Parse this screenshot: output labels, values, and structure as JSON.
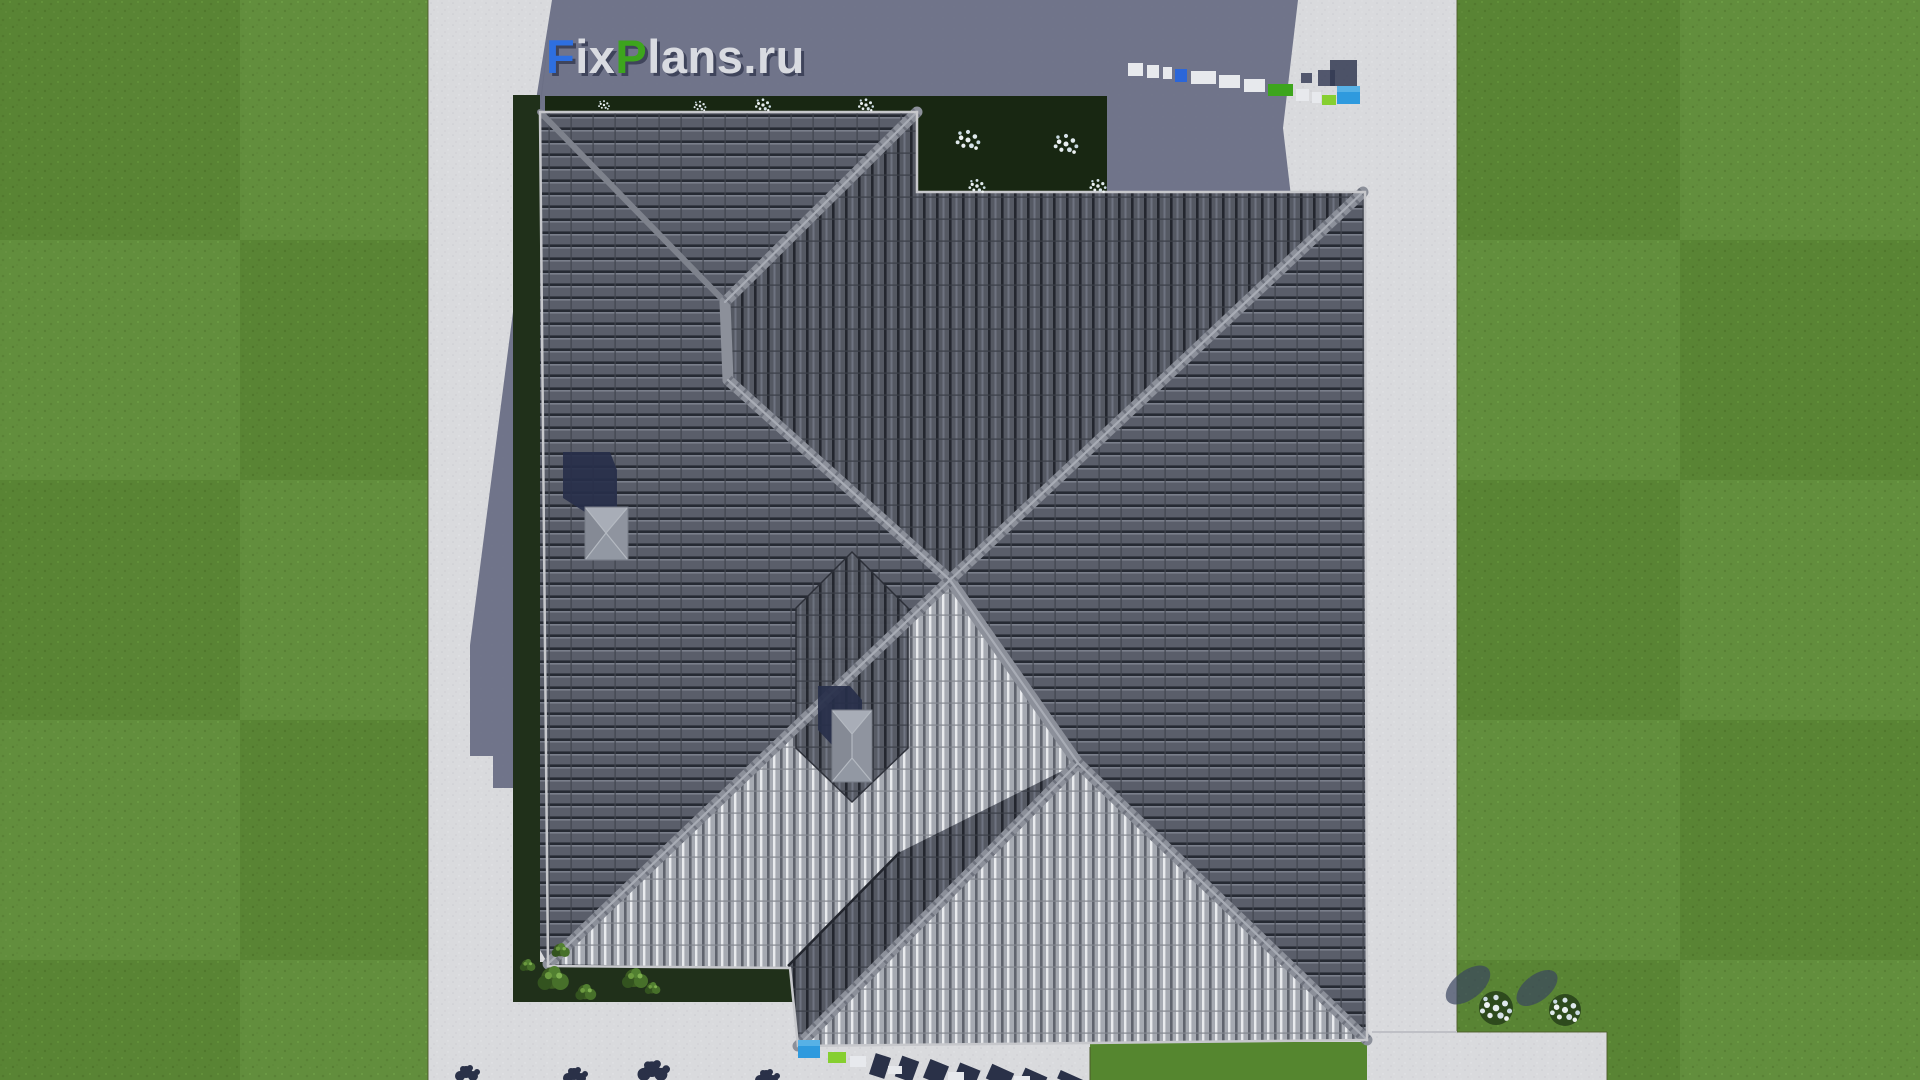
{
  "logo": {
    "full": "FixPlans.ru",
    "part1": "F",
    "part2": "ix",
    "part3": "P",
    "part4": "lans.ru"
  },
  "palette": {
    "lawn": "#5d8a37",
    "lawn_shadowed_strip": "#20301a",
    "garden_bed": "#182712",
    "concrete": "#d9dadd",
    "concrete_shadow": "#6a6f85",
    "roof_tiles_dark": "#555963",
    "roof_tiles_rows": "#5a5e6a",
    "roof_tiles_sunlit": "#a6aab2",
    "ridge_cap": "#8c909a",
    "cast_shadow_navy": "#272f4a",
    "logo_blue": "#2e6fe0",
    "logo_green": "#3da51d",
    "block_blue": "#2f9ade",
    "block_lime": "#86cf30",
    "flowers_white": "#eef1ef"
  }
}
